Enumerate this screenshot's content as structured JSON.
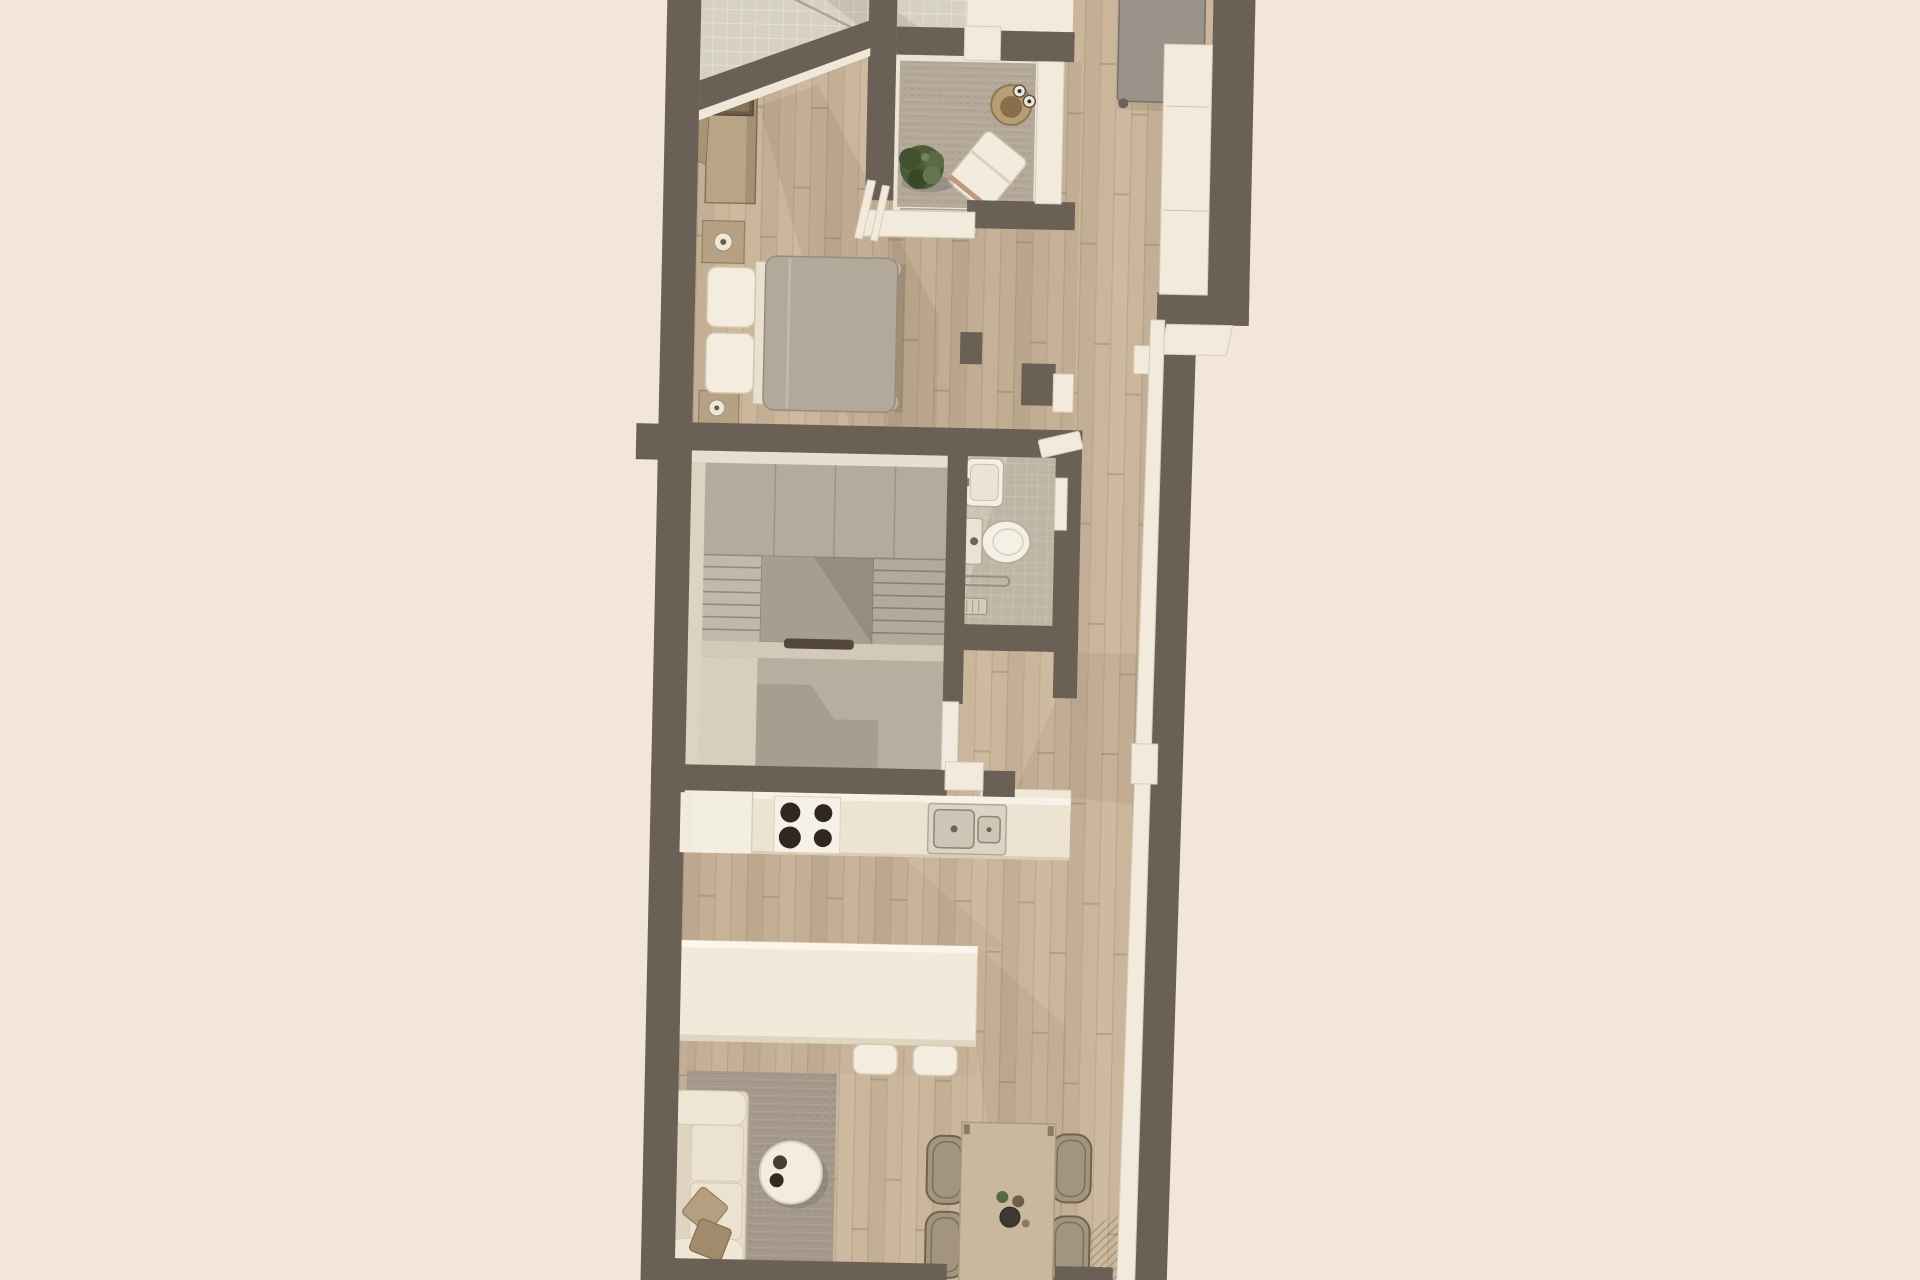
{
  "scene": {
    "title": "Apartment floor plan — top-down 3D render",
    "style": "architectural visualization, no text labels",
    "background_color": "#f2e5da",
    "wall_color": "#6b6055",
    "wood_floor_color": "#cbb69b",
    "accent_cream": "#f0e8da",
    "accent_gray": "#9a9389"
  },
  "rooms": {
    "tiled_room": {
      "label": "Tiled room (cut off at top edge)"
    },
    "bedroom": {
      "label": "Bedroom",
      "furniture": [
        "wardrobe with decor box",
        "nightstand with lamp",
        "double bed with gray duvet and two white pillows",
        "second nightstand with lamp"
      ]
    },
    "balcony": {
      "label": "Loggia balcony",
      "furniture": [
        "gray area rug",
        "round side table with two cups",
        "white lounge chair",
        "potted plant",
        "glass planter box"
      ],
      "cups": 2
    },
    "hallway": {
      "label": "Hallway along right side",
      "furniture": [
        "gray daybed"
      ],
      "window_sills": 4
    },
    "staircase": {
      "label": "Staircase hall",
      "furniture": [
        "U-shaped stair flights",
        "central landing",
        "handrail"
      ],
      "steps_per_flight": 6
    },
    "bathroom": {
      "label": "Bathroom",
      "furniture": [
        "wall-hung sink",
        "toilet",
        "shower bar",
        "floor drain",
        "open door"
      ]
    },
    "kitchen": {
      "label": "Kitchen",
      "furniture": [
        "counter run",
        "tall white cabinet",
        "cooktop",
        "double sink",
        "open door"
      ],
      "burners": 4
    },
    "island": {
      "label": "Kitchen island",
      "stools": 2
    },
    "living": {
      "label": "Living room",
      "furniture": [
        "gray rug",
        "cream sofa",
        "two throw pillows",
        "round coffee table"
      ],
      "coffee_cups": 2
    },
    "dining": {
      "label": "Dining area",
      "furniture": [
        "wooden dining table",
        "wicker chairs",
        "tableware set"
      ],
      "chairs": 4
    }
  }
}
